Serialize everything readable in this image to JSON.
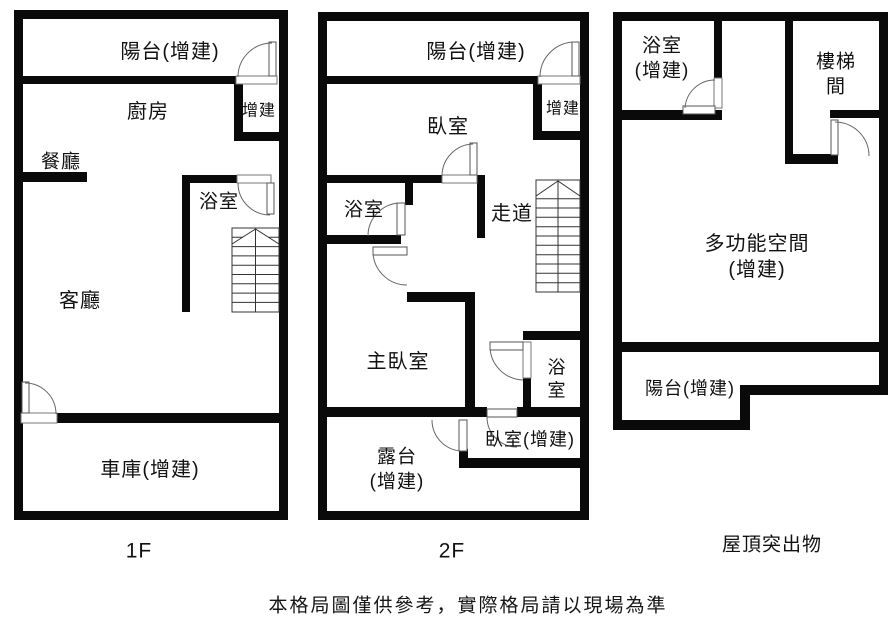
{
  "title": "floor-plan",
  "colors": {
    "wall": "#0a0a0a",
    "background": "#ffffff",
    "thin_line": "#555555",
    "stair_line": "#333333",
    "text": "#111111"
  },
  "floors": [
    {
      "id": "1F",
      "label": "1F",
      "rooms": {
        "balcony": "陽台(增建)",
        "kitchen": "廚房",
        "addition": "增建",
        "dining": "餐廳",
        "bath": "浴室",
        "living": "客廳",
        "garage": "車庫(增建)"
      }
    },
    {
      "id": "2F",
      "label": "2F",
      "rooms": {
        "balcony": "陽台(增建)",
        "bedroom": "臥室",
        "addition": "增建",
        "bath_left": "浴室",
        "corridor": "走道",
        "master": "主臥室",
        "bath_right": "浴\n室",
        "bedroom_add": "臥室(增建)",
        "terrace": "露台\n(增建)"
      }
    },
    {
      "id": "roof",
      "label": "屋頂突出物",
      "rooms": {
        "bath": "浴室\n(增建)",
        "stairwell": "樓梯間",
        "multi": "多功能空間(增建)",
        "balcony": "陽台(增建)"
      }
    }
  ],
  "caption": "本格局圖僅供參考，實際格局請以現場為準"
}
